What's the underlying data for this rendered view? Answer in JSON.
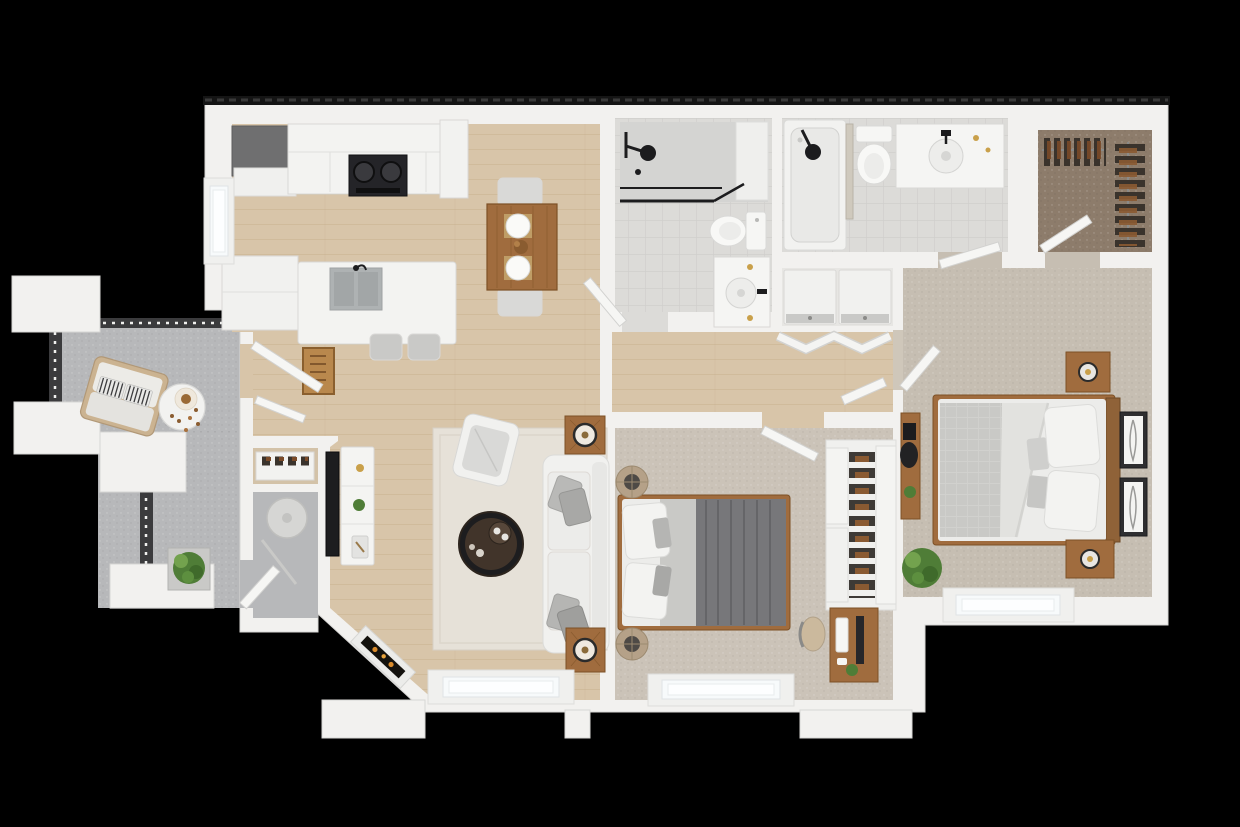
{
  "scene": {
    "type": "3d-floor-plan-render",
    "description": "Top-down 3D render of a two-bedroom two-bath apartment with balcony, shown on a black background",
    "background": "#000000"
  },
  "colors": {
    "wall": "#f2f1ef",
    "wall_shade": "#e3e2e0",
    "roof_edge": "#151515",
    "wood_floor": "#d8c5a9",
    "tile_floor": "#dcdbd8",
    "carpet_master": "#c6beb2",
    "carpet_bedroom": "#cbc3b8",
    "carpet_closet": "#8d7c6b",
    "concrete": "#b7b8ba",
    "rug": "#e6e1d8",
    "wood_furniture": "#a06c3e",
    "fixture_dark": "#1d1d1f",
    "appliance_gray": "#6f6f70",
    "fabric_white": "#efefed",
    "fabric_gray": "#a2a2a4",
    "duvet_gray": "#77777a",
    "quilt_silver": "#c9c9c6",
    "greenery": "#4f7d37",
    "flame": "#d98a2b",
    "glass": "#f7fafb",
    "railing": "#3b3b3d",
    "doormat": "#b9884d",
    "sink_gray": "#aeb2b3",
    "tan_leather": "#cbb99d",
    "pouf_tan": "#b5a188"
  },
  "rooms": [
    {
      "id": "kitchen",
      "label": "kitchen",
      "floor": "wood"
    },
    {
      "id": "dining-area",
      "label": "dining area",
      "floor": "wood"
    },
    {
      "id": "living-room",
      "label": "living room",
      "floor": "wood"
    },
    {
      "id": "entry",
      "label": "entry",
      "floor": "wood"
    },
    {
      "id": "hallway",
      "label": "hallway",
      "floor": "wood"
    },
    {
      "id": "bathroom",
      "label": "hall bathroom",
      "floor": "tile"
    },
    {
      "id": "primary-bathroom",
      "label": "primary bathroom",
      "floor": "tile"
    },
    {
      "id": "laundry-closet",
      "label": "laundry closet",
      "floor": "tile"
    },
    {
      "id": "walk-in-closet",
      "label": "walk-in closet",
      "floor": "carpet"
    },
    {
      "id": "primary-bedroom",
      "label": "primary bedroom",
      "floor": "carpet"
    },
    {
      "id": "bedroom-2",
      "label": "bedroom 2",
      "floor": "carpet"
    },
    {
      "id": "storage-room",
      "label": "storage room",
      "floor": "concrete"
    },
    {
      "id": "shoe-closet",
      "label": "shoe closet",
      "floor": "wood"
    },
    {
      "id": "balcony",
      "label": "balcony",
      "floor": "concrete"
    }
  ],
  "furniture": {
    "kitchen": [
      "refrigerator",
      "upper-counter",
      "range-cooktop",
      "pantry-cabinet",
      "window-counter",
      "island-with-sink",
      "bar-stools",
      "doormat"
    ],
    "dining": [
      "dining-table",
      "place-settings",
      "dining-chairs"
    ],
    "living": [
      "area-rug",
      "armchair",
      "sofa",
      "throw-pillows",
      "round-coffee-table",
      "side-table-lamps",
      "tv",
      "media-console",
      "fireplace",
      "window"
    ],
    "bathroom": [
      "walk-in-shower",
      "toilet",
      "vanity-sink",
      "door"
    ],
    "primary_bathroom": [
      "bathtub",
      "toilet",
      "vanity-sink",
      "door"
    ],
    "laundry": [
      "washer",
      "dryer",
      "bifold-doors"
    ],
    "walk_in_closet": [
      "hanging-clothes",
      "door"
    ],
    "primary_bedroom": [
      "queen-bed",
      "headboard",
      "nightstands",
      "table-lamps",
      "wall-art",
      "desk",
      "desk-chair",
      "floor-plant",
      "window"
    ],
    "bedroom_2": [
      "bed",
      "gray-duvet",
      "poufs",
      "sliding-door-closet",
      "shoe-rack",
      "desk",
      "desk-chair",
      "monitor",
      "pc-tower",
      "window"
    ],
    "storage": [
      "water-heater",
      "door"
    ],
    "balcony": [
      "railings",
      "privacy-walls",
      "loveseat",
      "striped-pillows",
      "round-table",
      "planter-box",
      "storage-door"
    ]
  }
}
